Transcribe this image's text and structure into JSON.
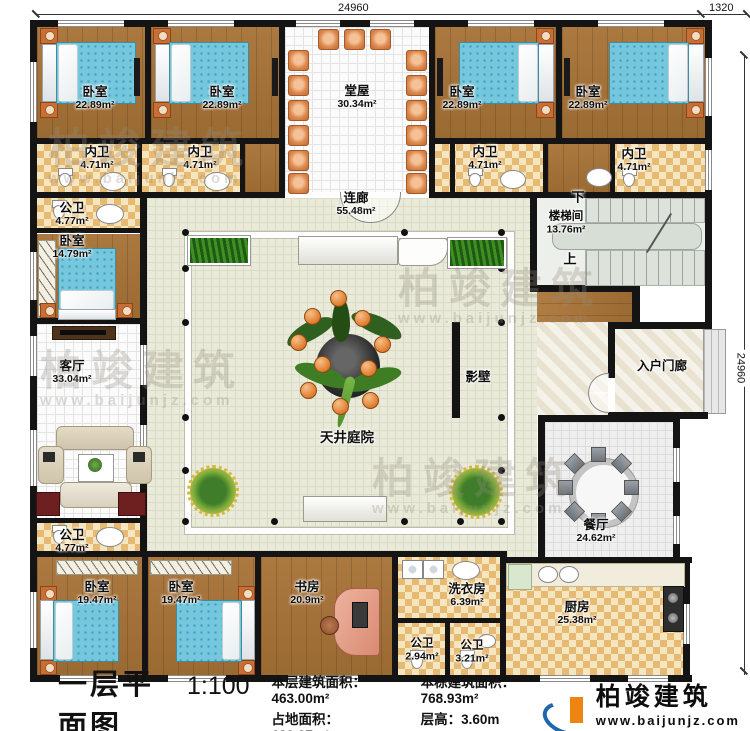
{
  "dimensions": {
    "top": "24960",
    "top_right": "1320",
    "right": "24960"
  },
  "rooms": {
    "bedroom_tl1": {
      "name": "卧室",
      "area": "22.89m²"
    },
    "bedroom_tl2": {
      "name": "卧室",
      "area": "22.89m²"
    },
    "tangwu": {
      "name": "堂屋",
      "area": "30.34m²"
    },
    "bedroom_tr1": {
      "name": "卧室",
      "area": "22.89m²"
    },
    "bedroom_tr2": {
      "name": "卧室",
      "area": "22.89m²"
    },
    "neiwei_1": {
      "name": "内卫",
      "area": "4.71m²"
    },
    "neiwei_2": {
      "name": "内卫",
      "area": "4.71m²"
    },
    "neiwei_3": {
      "name": "内卫",
      "area": "4.71m²"
    },
    "neiwei_4": {
      "name": "内卫",
      "area": "4.71m²"
    },
    "gongwei_tl": {
      "name": "公卫",
      "area": "4.77m²"
    },
    "lianlang": {
      "name": "连廊",
      "area": "55.48m²"
    },
    "loutijian": {
      "name": "楼梯间",
      "area": "13.76m²"
    },
    "stair_down": {
      "name": "下"
    },
    "stair_up": {
      "name": "上"
    },
    "bedroom_left": {
      "name": "卧室",
      "area": "14.79m²"
    },
    "keting": {
      "name": "客厅",
      "area": "33.04m²"
    },
    "ruhumenlang": {
      "name": "入户门廊"
    },
    "yingbi": {
      "name": "影壁"
    },
    "tianjing": {
      "name": "天井庭院"
    },
    "canting": {
      "name": "餐厅",
      "area": "24.62m²"
    },
    "gongwei_bl": {
      "name": "公卫",
      "area": "4.77m²"
    },
    "bedroom_bl1": {
      "name": "卧室",
      "area": "19.47m²"
    },
    "bedroom_bl2": {
      "name": "卧室",
      "area": "19.47m²"
    },
    "shufang": {
      "name": "书房",
      "area": "20.9m²"
    },
    "xiyifang": {
      "name": "洗衣房",
      "area": "6.39m²"
    },
    "gongwei_b1": {
      "name": "公卫",
      "area": "2.94m²"
    },
    "gongwei_b2": {
      "name": "公卫",
      "area": "3.21m²"
    },
    "chufang": {
      "name": "厨房",
      "area": "25.38m²"
    }
  },
  "footer": {
    "title": "一层平面图",
    "scale": "1:100",
    "stats": [
      {
        "label": "本层建筑面积：",
        "value": "463.00m²"
      },
      {
        "label": "本栋建筑面积：",
        "value": "768.93m²"
      },
      {
        "label": "占地面积：",
        "value": "639.07m²"
      },
      {
        "label": "层高：",
        "value": "3.60m"
      }
    ],
    "brand": {
      "name": "柏竣建筑",
      "url": "www.baijunjz.com"
    }
  },
  "watermark": {
    "name": "柏竣建筑",
    "url": "www.baijunjz.com"
  },
  "colors": {
    "brand_blue": "#1c67ae",
    "brand_orange": "#ee8511",
    "wall": "#141414"
  }
}
